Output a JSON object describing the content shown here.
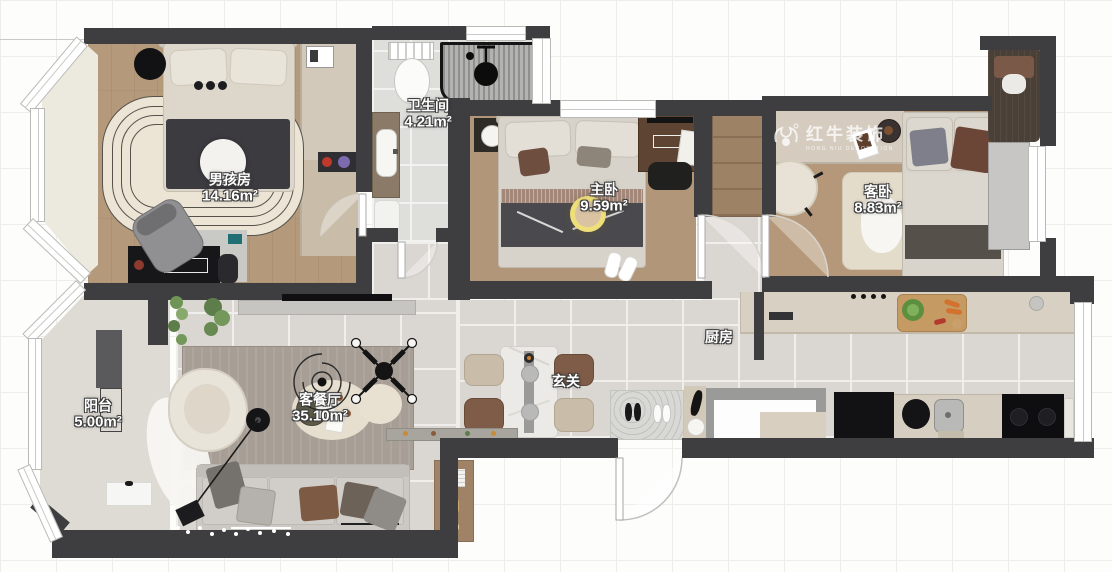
{
  "rooms": [
    {
      "id": "boy-room",
      "name": "男孩房",
      "area": "14.16m²"
    },
    {
      "id": "bathroom",
      "name": "卫生间",
      "area": "4.21m²"
    },
    {
      "id": "master-bedroom",
      "name": "主卧",
      "area": "9.59m²"
    },
    {
      "id": "guest-bedroom",
      "name": "客卧",
      "area": "8.83m²"
    },
    {
      "id": "kitchen",
      "name": "厨房",
      "area": ""
    },
    {
      "id": "entry",
      "name": "玄关",
      "area": ""
    },
    {
      "id": "living-dining",
      "name": "客餐厅",
      "area": "35.10m²"
    },
    {
      "id": "balcony",
      "name": "阳台",
      "area": "5.00m²"
    }
  ],
  "watermark": {
    "brand": "红牛装饰",
    "sub": "HONG NIU DECORATION"
  },
  "colors": {
    "wall": "#3e3e40",
    "wood_floor": "#b5997b",
    "tile_floor": "#dad6d1",
    "area_ring": "#efdf7a"
  }
}
